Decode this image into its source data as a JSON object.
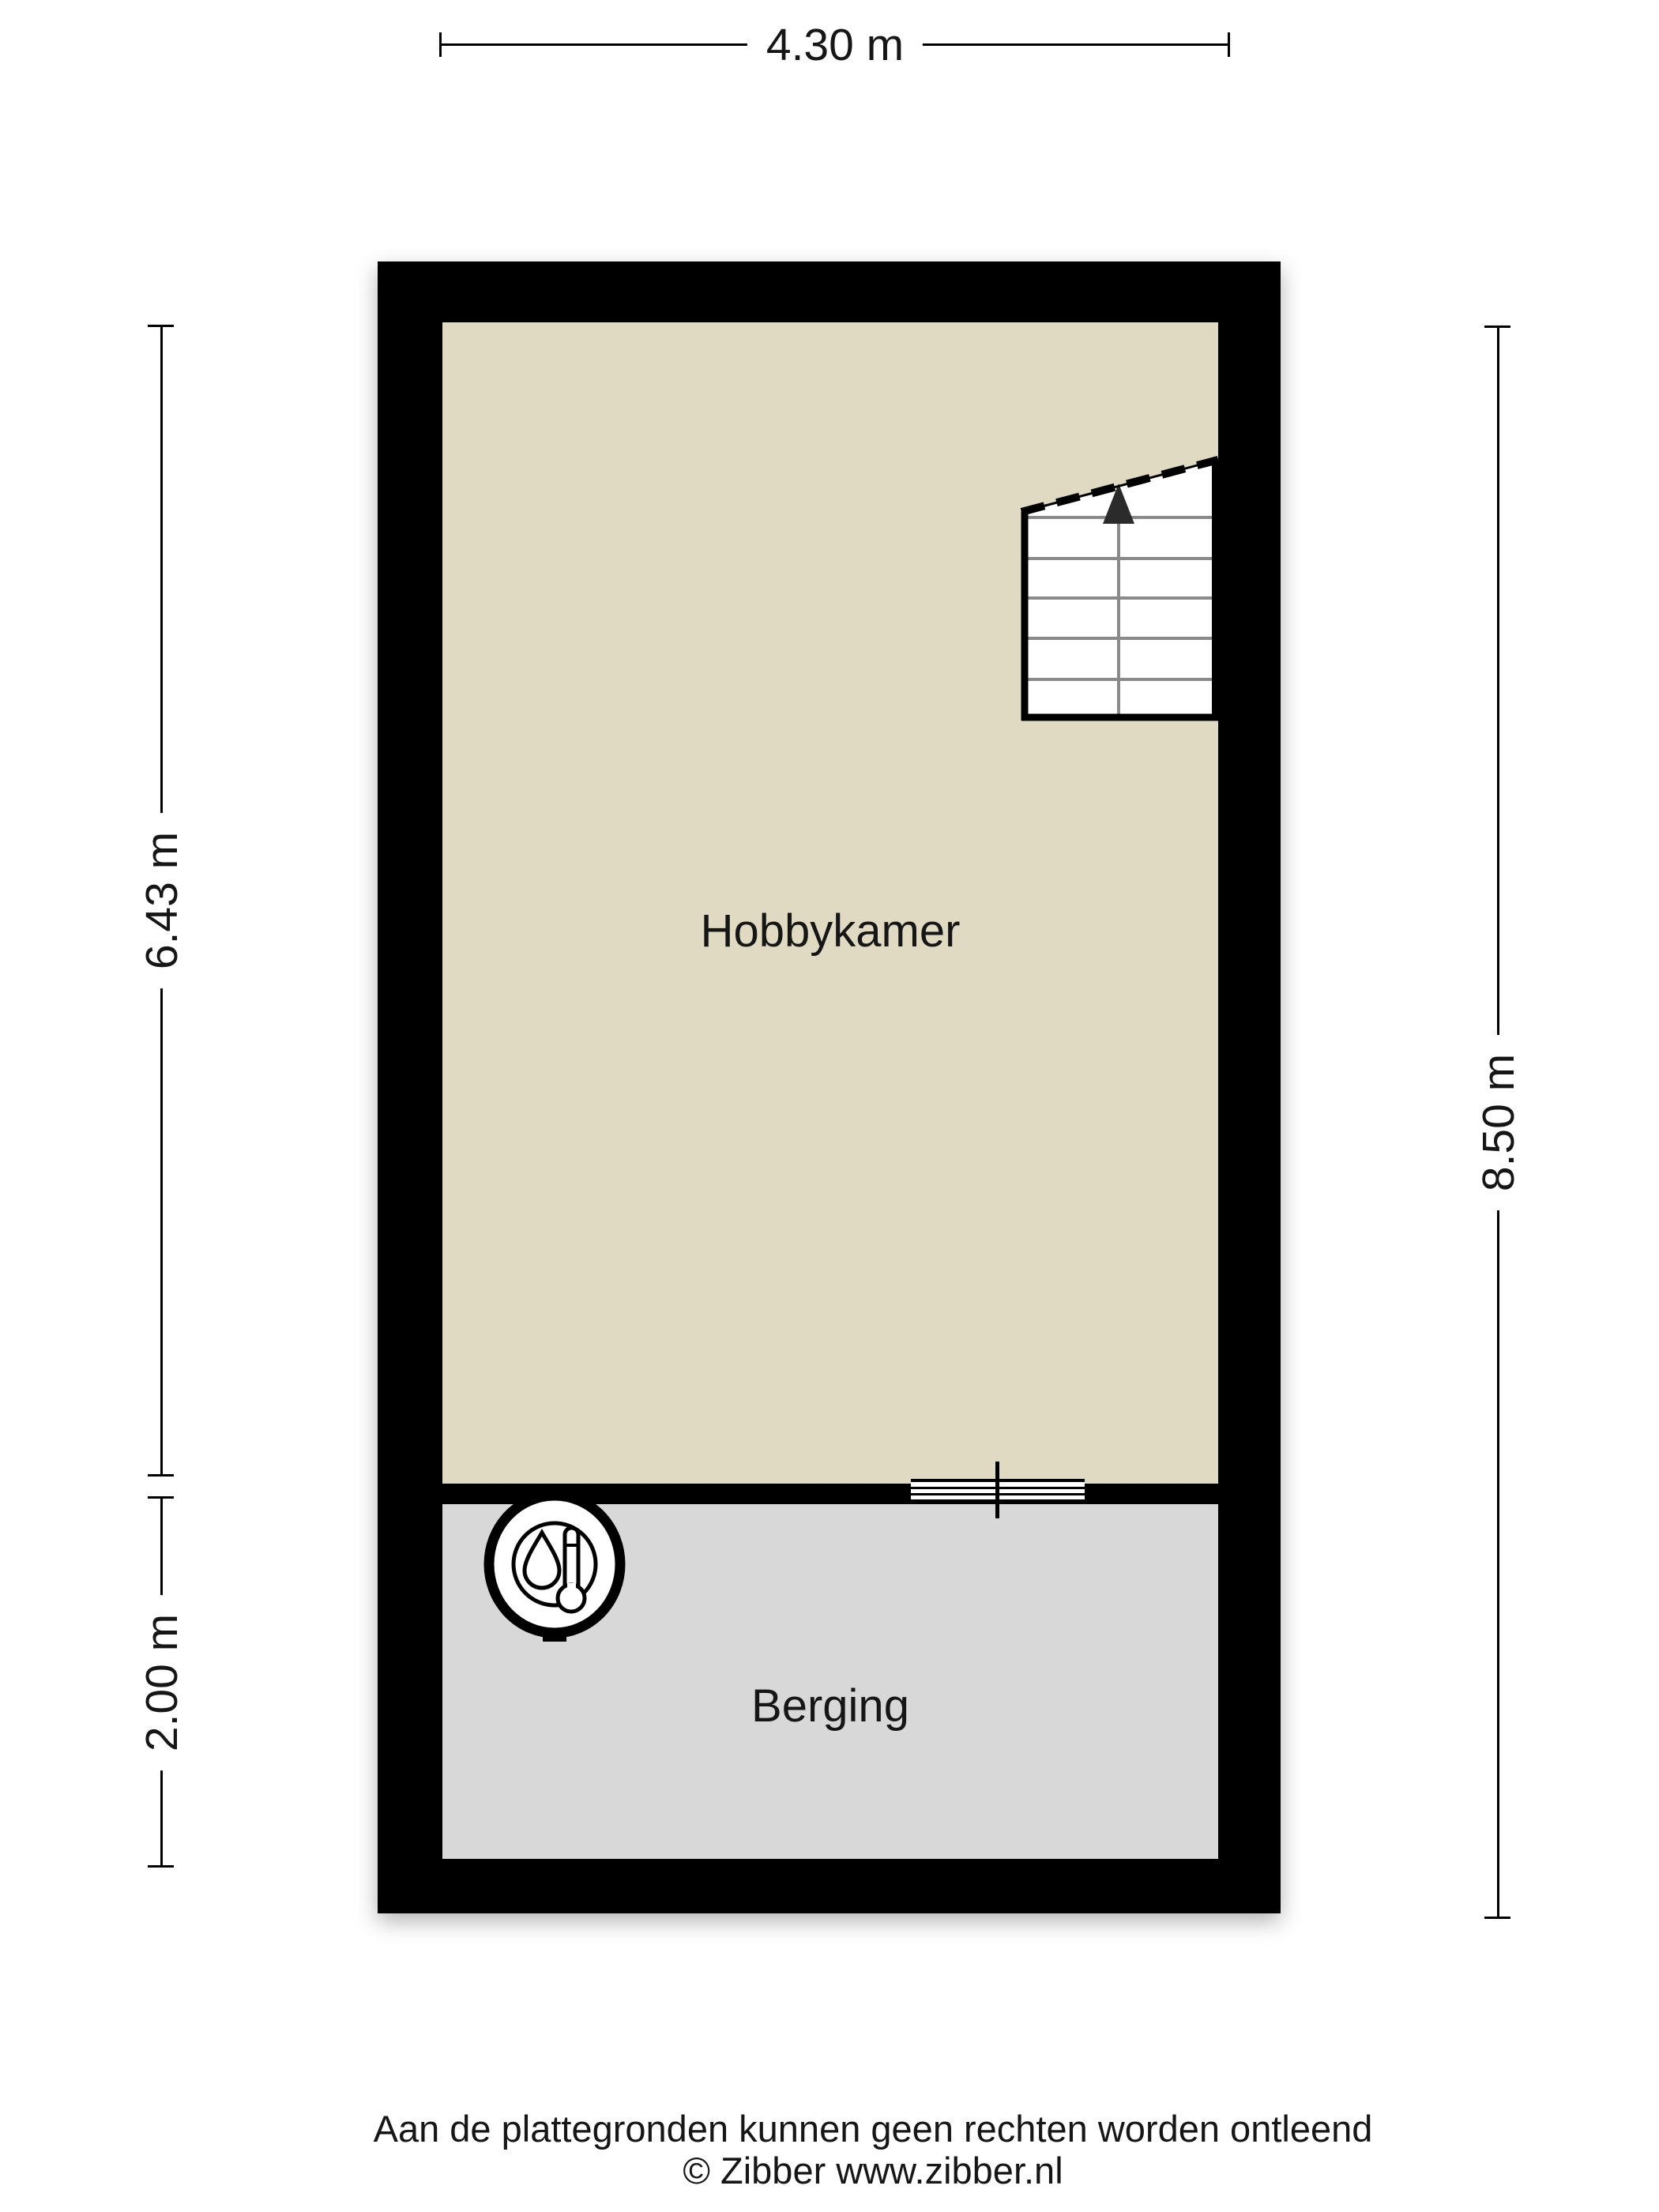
{
  "floorplan": {
    "rooms": [
      {
        "name": "Hobbykamer",
        "floor_color": "#E0DAC2"
      },
      {
        "name": "Berging",
        "floor_color": "#D8D8D8"
      }
    ],
    "dimensions": {
      "top": "4.30 m",
      "left_upper": "6.43 m",
      "left_lower": "2.00 m",
      "right": "8.50 m"
    },
    "icons": [
      {
        "name": "boiler-icon"
      },
      {
        "name": "stairs-up-arrow-icon"
      },
      {
        "name": "door-symbol"
      }
    ],
    "colors": {
      "wall": "#000000",
      "hobbykamer_floor": "#E0DAC2",
      "berging_floor": "#D8D8D8",
      "background": "#FFFFFF"
    }
  },
  "footer": {
    "disclaimer": "Aan de plattegronden kunnen geen rechten worden ontleend",
    "copyright": "© Zibber www.zibber.nl"
  }
}
